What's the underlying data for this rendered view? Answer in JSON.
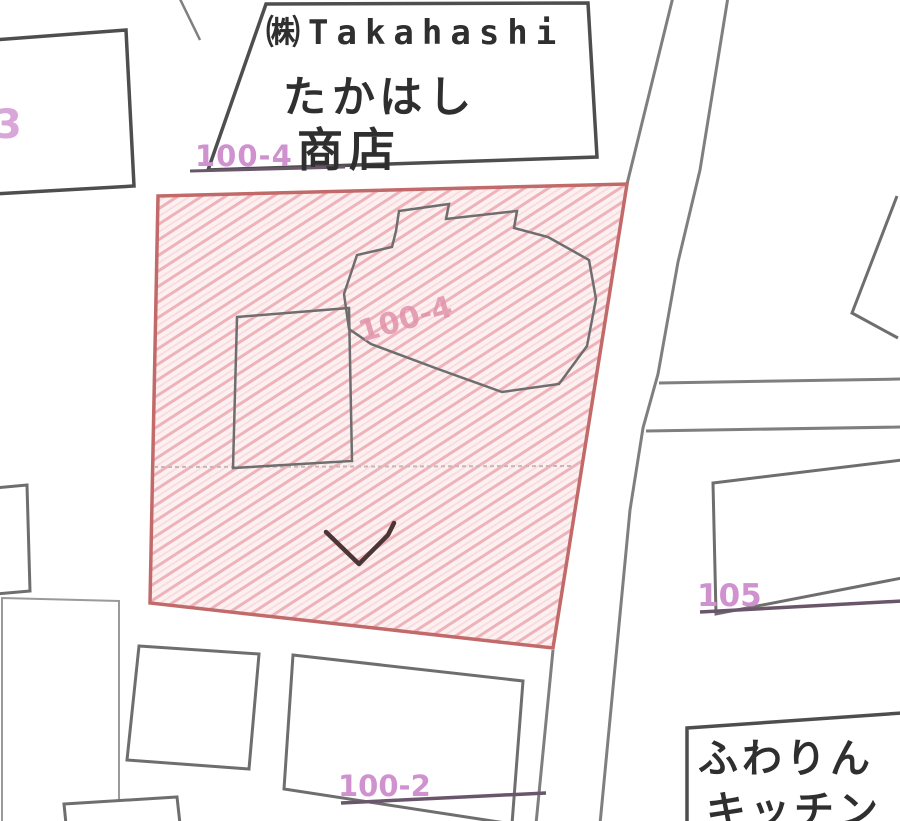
{
  "map": {
    "labels": {
      "store_name_line1": "㈱Takahashi",
      "store_name_line2": "たかはし",
      "store_name_line3": "商店",
      "shop2_line1": "ふわりん",
      "shop2_line2": "キッチン"
    },
    "parcel_numbers": {
      "left_partial": "3",
      "top": "100-4",
      "selected_center": "100-4",
      "right": "105",
      "bottom": "100-2"
    },
    "symbols": {
      "v_mark": "land-use-v-symbol"
    },
    "colors": {
      "selected_parcel_border": "#c26a6a",
      "selected_parcel_fill": "#fdf0f0",
      "hatch_line": "#eeb3ba",
      "hatch_line_light": "#f8dde0",
      "parcel_number_magenta": "#cf92cf",
      "parcel_number_faint": "#d9a6d9",
      "parcel_number_inner": "#e093ab",
      "leader_line": "#6a566a",
      "building_outline": "#6e6e6e",
      "building_outline_dark": "#4e4e4e",
      "road_line": "#7f7f7f",
      "faint_line": "#9a9a9a",
      "subdivision_line": "#c9b6b6",
      "v_mark_color": "#4b3535",
      "text_dark": "#2f2f2f"
    }
  }
}
